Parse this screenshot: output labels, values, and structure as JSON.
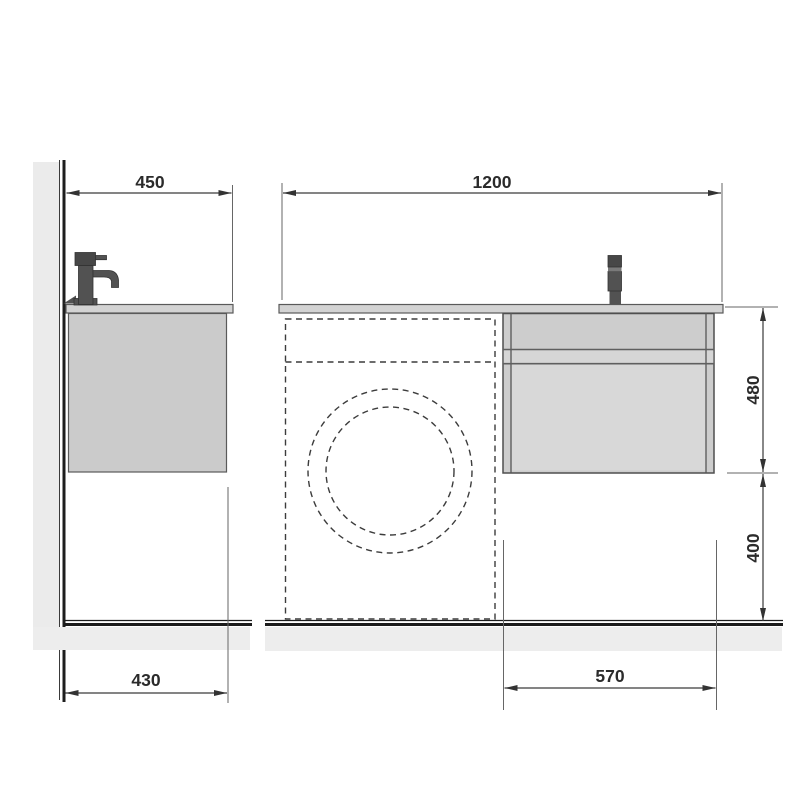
{
  "drawing": {
    "dimension_labels": {
      "side_countertop_depth": "450",
      "side_floor_depth": "430",
      "front_total_width": "1200",
      "front_cabinet_width": "570",
      "front_cabinet_height": "480",
      "front_clearance_height": "400"
    },
    "colors": {
      "wall_fill": "#ebebeb",
      "floor_shadow_fill": "#ededed",
      "countertop_fill": "#d3d3d3",
      "side_cabinet_fill": "#cbcbcb",
      "front_cabinet_fill": "#cdcdcd",
      "rail_fill": "#d6d6d6",
      "drawer_fill": "#d8d8d8",
      "faucet_dark": "#474747",
      "faucet_mid": "#525252",
      "faucet_light": "#7a7a7a",
      "line": "#333333",
      "text": "#2b2b2b"
    }
  }
}
